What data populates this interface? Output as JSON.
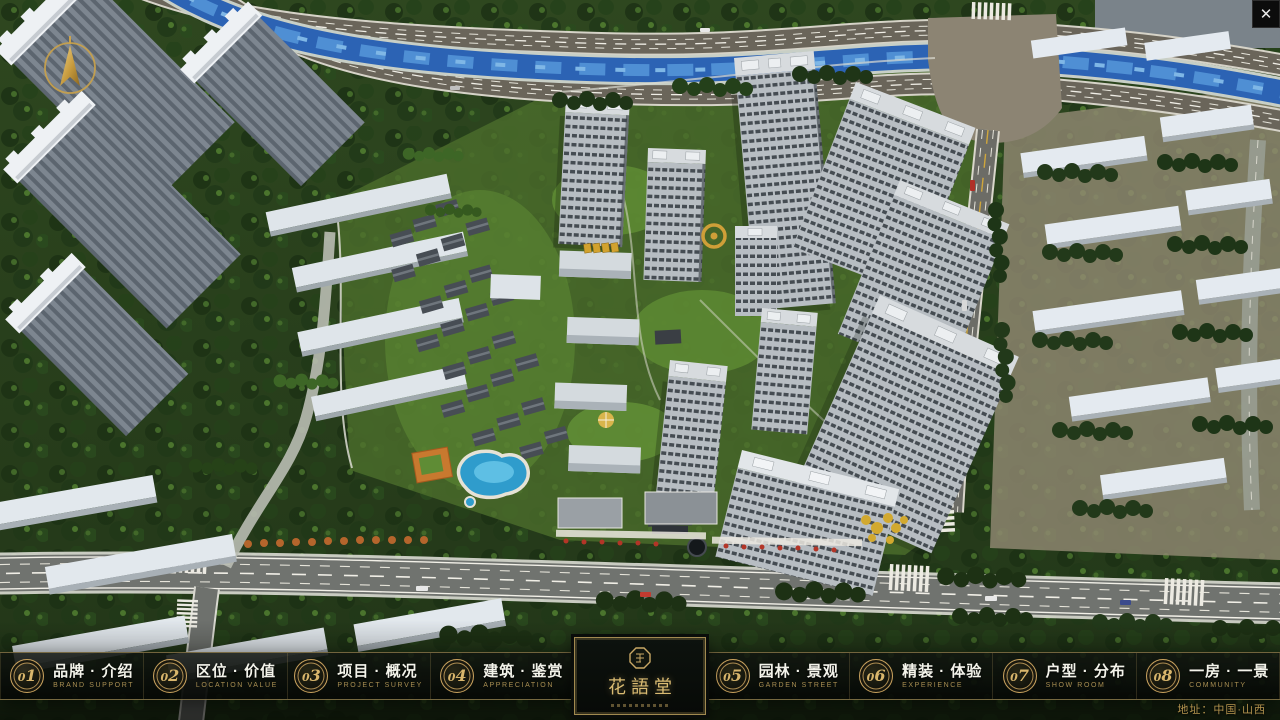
{
  "colors": {
    "gold_accent": "#c9a765",
    "gold_dim": "#a88e52",
    "bar_background": "#0b0f0c",
    "label_text": "#f3f3ea",
    "river_blue": "#2c63b4"
  },
  "viewer": {
    "close_glyph": "✕"
  },
  "nav": {
    "items": [
      {
        "num": "01",
        "zh": "品牌 · 介绍",
        "en": "BRAND SUPPORT"
      },
      {
        "num": "02",
        "zh": "区位 · 价值",
        "en": "LOCATION VALUE"
      },
      {
        "num": "03",
        "zh": "项目 · 概况",
        "en": "PROJECT SURVEY"
      },
      {
        "num": "04",
        "zh": "建筑 · 鉴赏",
        "en": "APPRECIATION"
      },
      {
        "num": "05",
        "zh": "园林 · 景观",
        "en": "GARDEN STREET"
      },
      {
        "num": "06",
        "zh": "精装 · 体验",
        "en": "EXPERIENCE"
      },
      {
        "num": "07",
        "zh": "户型 · 分布",
        "en": "SHOW ROOM"
      },
      {
        "num": "08",
        "zh": "一房 · 一景",
        "en": "COMMUNITY"
      }
    ]
  },
  "logo": {
    "title": "花語堂"
  },
  "footer": {
    "address": "地址：中国·山西"
  }
}
